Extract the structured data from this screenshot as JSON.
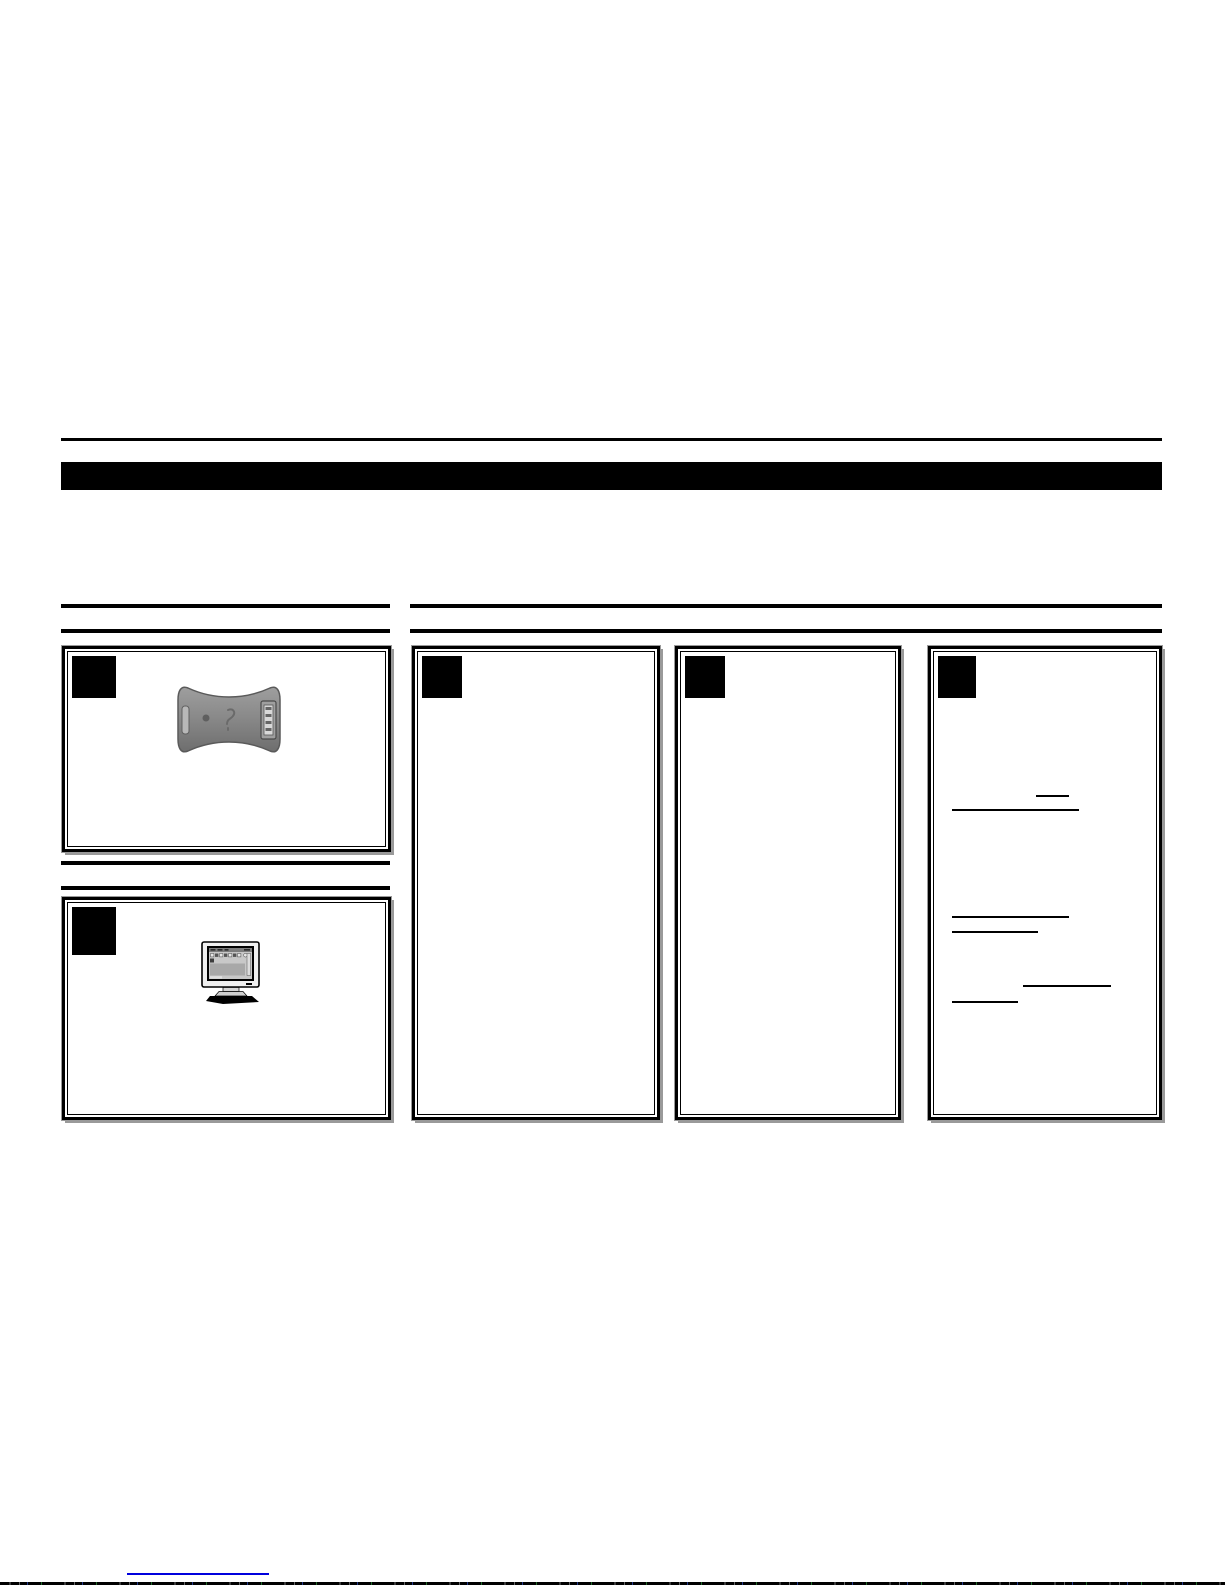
{
  "page": {
    "background_color": "#ffffff",
    "kind": "quick-start-guide-page",
    "bottom_edge_artifact": "scanline-noise-strip"
  },
  "header": {
    "top_rule_color": "#000000",
    "title_bar_color": "#000000",
    "title_bar_text": ""
  },
  "section_rules": {
    "color": "#000000",
    "left_column_pairs": 2,
    "right_column_pairs": 1
  },
  "boxes": {
    "border_color": "#000000",
    "shadow_color": "#9a9a9a",
    "step_marker": "solid-black-square",
    "left_column": [
      {
        "id": "step-box-1",
        "image": "usb-adapter-device-photo"
      },
      {
        "id": "step-box-2",
        "image": "crt-monitor-clipart"
      }
    ],
    "right_column": [
      {
        "id": "step-box-3"
      },
      {
        "id": "step-box-4"
      },
      {
        "id": "step-box-5",
        "underline_marks": 6
      }
    ]
  },
  "images": {
    "usb_adapter": {
      "description": "gray bowtie-shaped adapter with USB port",
      "body_color": "#8a8a8a",
      "edge_color": "#5a5a5a"
    },
    "monitor": {
      "description": "CRT monitor showing application window",
      "case_color": "#f0f0f0",
      "screen_color": "#c8c8c8",
      "shadow_color": "#000000"
    }
  },
  "footer": {
    "link_underline_color": "#0000dd"
  }
}
